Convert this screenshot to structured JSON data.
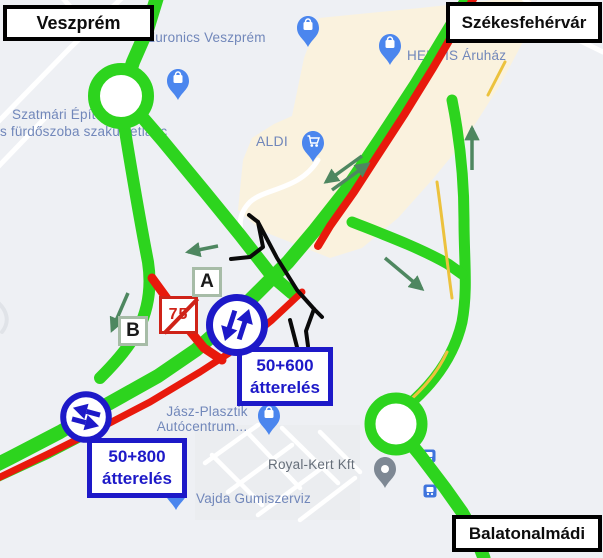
{
  "city_signs": {
    "veszprem": "Veszprém",
    "szekesfehervar": "Székesfehérvár",
    "balatonalmadi": "Balatonalmádi"
  },
  "detour_labels": {
    "d1_line1": "50+600",
    "d1_line2": "átterelés",
    "d2_line1": "50+800",
    "d2_line2": "átterelés"
  },
  "markers": {
    "a": "A",
    "b": "B"
  },
  "closed_route_sign": {
    "route_number": "75"
  },
  "map_labels": {
    "euronics": "Euronics Veszprém",
    "szatmari_line1": "Szatmári Építészeti",
    "szatmari_line2": "s fürdőszoba szaküzletlánc",
    "hervis": "HERVIS Áruház",
    "aldi": "ALDI",
    "jasz_line1": "Jász-Plasztik",
    "jasz_line2": "Autócentrum...",
    "royal_kert": "Royal-Kert Kft",
    "vajda": "Vajda Gumiszerviz"
  },
  "legend_colors": {
    "open_route_green": "#2dd41e",
    "closed_route_red": "#e8190c",
    "closed_ramp_black": "#0a0a0a",
    "detour_sign_blue": "#1d19c8",
    "direction_arrow_green": "#4e8760",
    "commercial_area_beige": "#faf2de",
    "map_pin_blue": "#4b86ee"
  }
}
